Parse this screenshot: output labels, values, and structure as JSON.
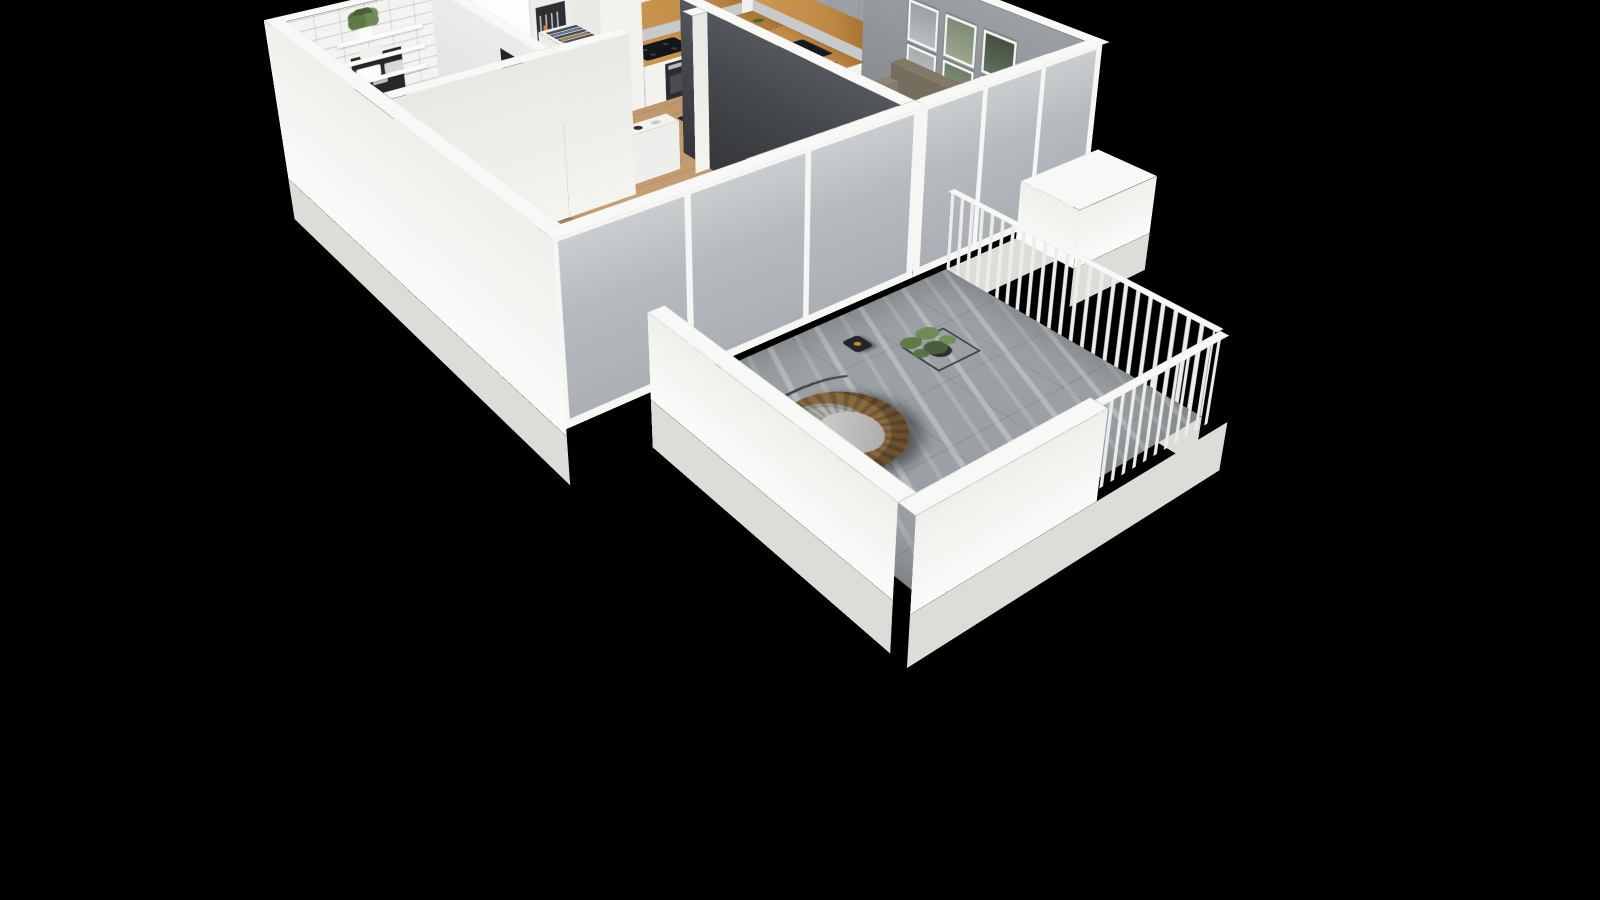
{
  "scene": {
    "name": "3D isometric cutaway floor plan render of a one-bedroom apartment on a black background",
    "view": "axonometric bird's-eye cutaway, walls sliced at top, apartment rotated diamond-wise",
    "background": "#000000"
  },
  "palette": {
    "bg": "#000000",
    "wall_top": "#f8f8f6",
    "wall_white": "#f4f4f1",
    "wall_shade": "#e8e8e5",
    "wall_outer": "#efefec",
    "skirt": "#dcdcd9",
    "gray_wall": "#8f9397",
    "dark_wall": "#44474b",
    "tile_wall": "#f3f4f1",
    "wood_floor": "#c59b6d",
    "bath_floor": "#eff1f2",
    "balcony_floor": "#9aa0a3",
    "counter_wood": "#c08a45",
    "cab_white": "#f2f2ef",
    "cab_gray": "#9aa0a5",
    "glass": "#b6bbbf",
    "mullion": "#f6f6f4",
    "sofa": "#8b8172",
    "sofa_dark": "#776e60",
    "rug": "#cbc5b8",
    "black_furniture": "#202225",
    "chair": "#2e3033",
    "bed": "#f0efec",
    "bed_shade": "#dddcd8",
    "plant": "#5d7a47",
    "plant_dark": "#46603a",
    "pot": "#2c2e30",
    "rattan": "#8a6a3e",
    "cushion": "#b5b5b1",
    "radiator": "#f3f3f1",
    "radiator_line": "#c6c6c3",
    "door_white": "#fdfdfc",
    "door_dark": "#232528",
    "accent_orange": "#dd7f2f",
    "frame_white": "#f5f5f3"
  },
  "rooms": [
    {
      "id": "bathroom",
      "name": "Bathroom",
      "furniture": [
        "white-subway-tile-wall",
        "wall-shelves",
        "towels",
        "potted-plant",
        "wall-hung-toilet",
        "wooden-counter",
        "dark-door",
        "diamond-pattern-tile-floor"
      ]
    },
    {
      "id": "hallway",
      "name": "Hallway",
      "furniture": [
        "white-entry-door",
        "coat-hanger-niche",
        "open-hanger-cabinet",
        "tall-white-cabinet",
        "white-sideboard",
        "open-bedroom-door"
      ]
    },
    {
      "id": "kitchen",
      "name": "Kitchen",
      "furniture": [
        "white-upper-cabinets",
        "gray-upper-cabinets",
        "oak-open-shelf-band",
        "lower-cabinets",
        "wood-countertop",
        "induction-hob",
        "oven",
        "black-sink",
        "faucet",
        "ventilation-shaft-niches"
      ]
    },
    {
      "id": "living-dining",
      "name": "Living / dining room",
      "furniture": [
        "gray-accent-wall",
        "six-framed-pictures",
        "three-seat-sofa",
        "beige-rug",
        "black-coffee-table",
        "armchair",
        "arc-floor-lamp",
        "tall-potted-plant",
        "black-dining-table",
        "four-black-chairs",
        "fruit-bowl",
        "plates",
        "radiator",
        "vertical-blinds",
        "glass-window-wall",
        "exterior-ledge"
      ]
    },
    {
      "id": "bedroom",
      "name": "Bedroom",
      "furniture": [
        "dark-accent-partition",
        "double-bed",
        "white-duvet",
        "pillows",
        "patterned-throw",
        "open-wardrobe",
        "hanging-clothes",
        "storage-boxes",
        "radiator",
        "potted-plant"
      ]
    },
    {
      "id": "balcony",
      "name": "Balcony",
      "furniture": [
        "hanging-rattan-egg-chair",
        "gray-blanket",
        "potted-plant-on-stand",
        "candle-lantern",
        "slatted-metal-railing",
        "white-parapet",
        "gray-tile-floor"
      ]
    }
  ]
}
